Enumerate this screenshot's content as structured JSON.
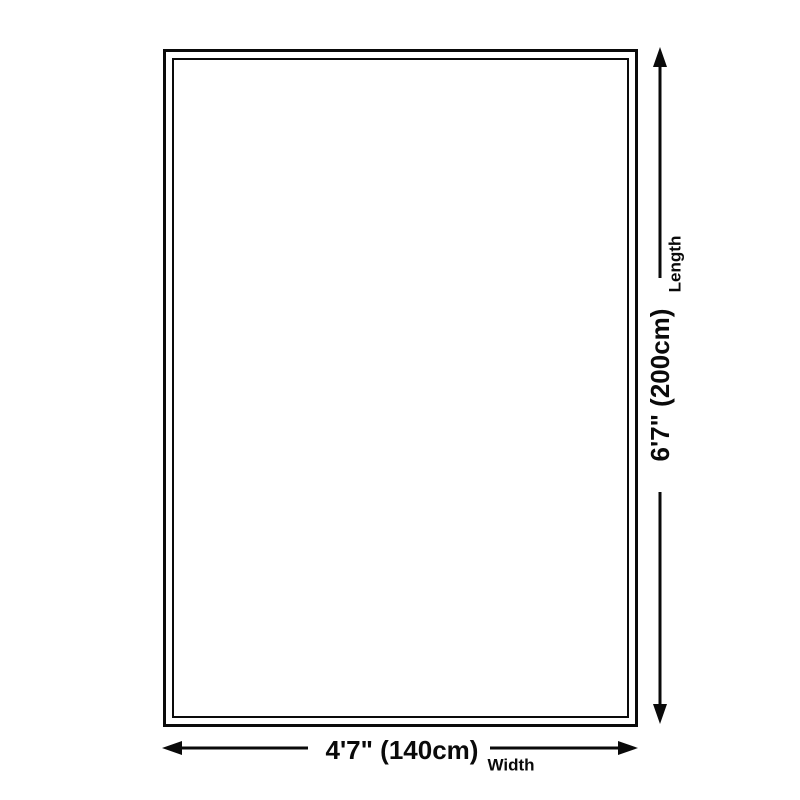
{
  "diagram": {
    "length": {
      "value": "6'7\" (200cm)",
      "label": "Length"
    },
    "width": {
      "value": "4'7\" (140cm)",
      "label": "Width"
    },
    "colors": {
      "line": "#0a0a0a",
      "background": "#ffffff"
    }
  }
}
